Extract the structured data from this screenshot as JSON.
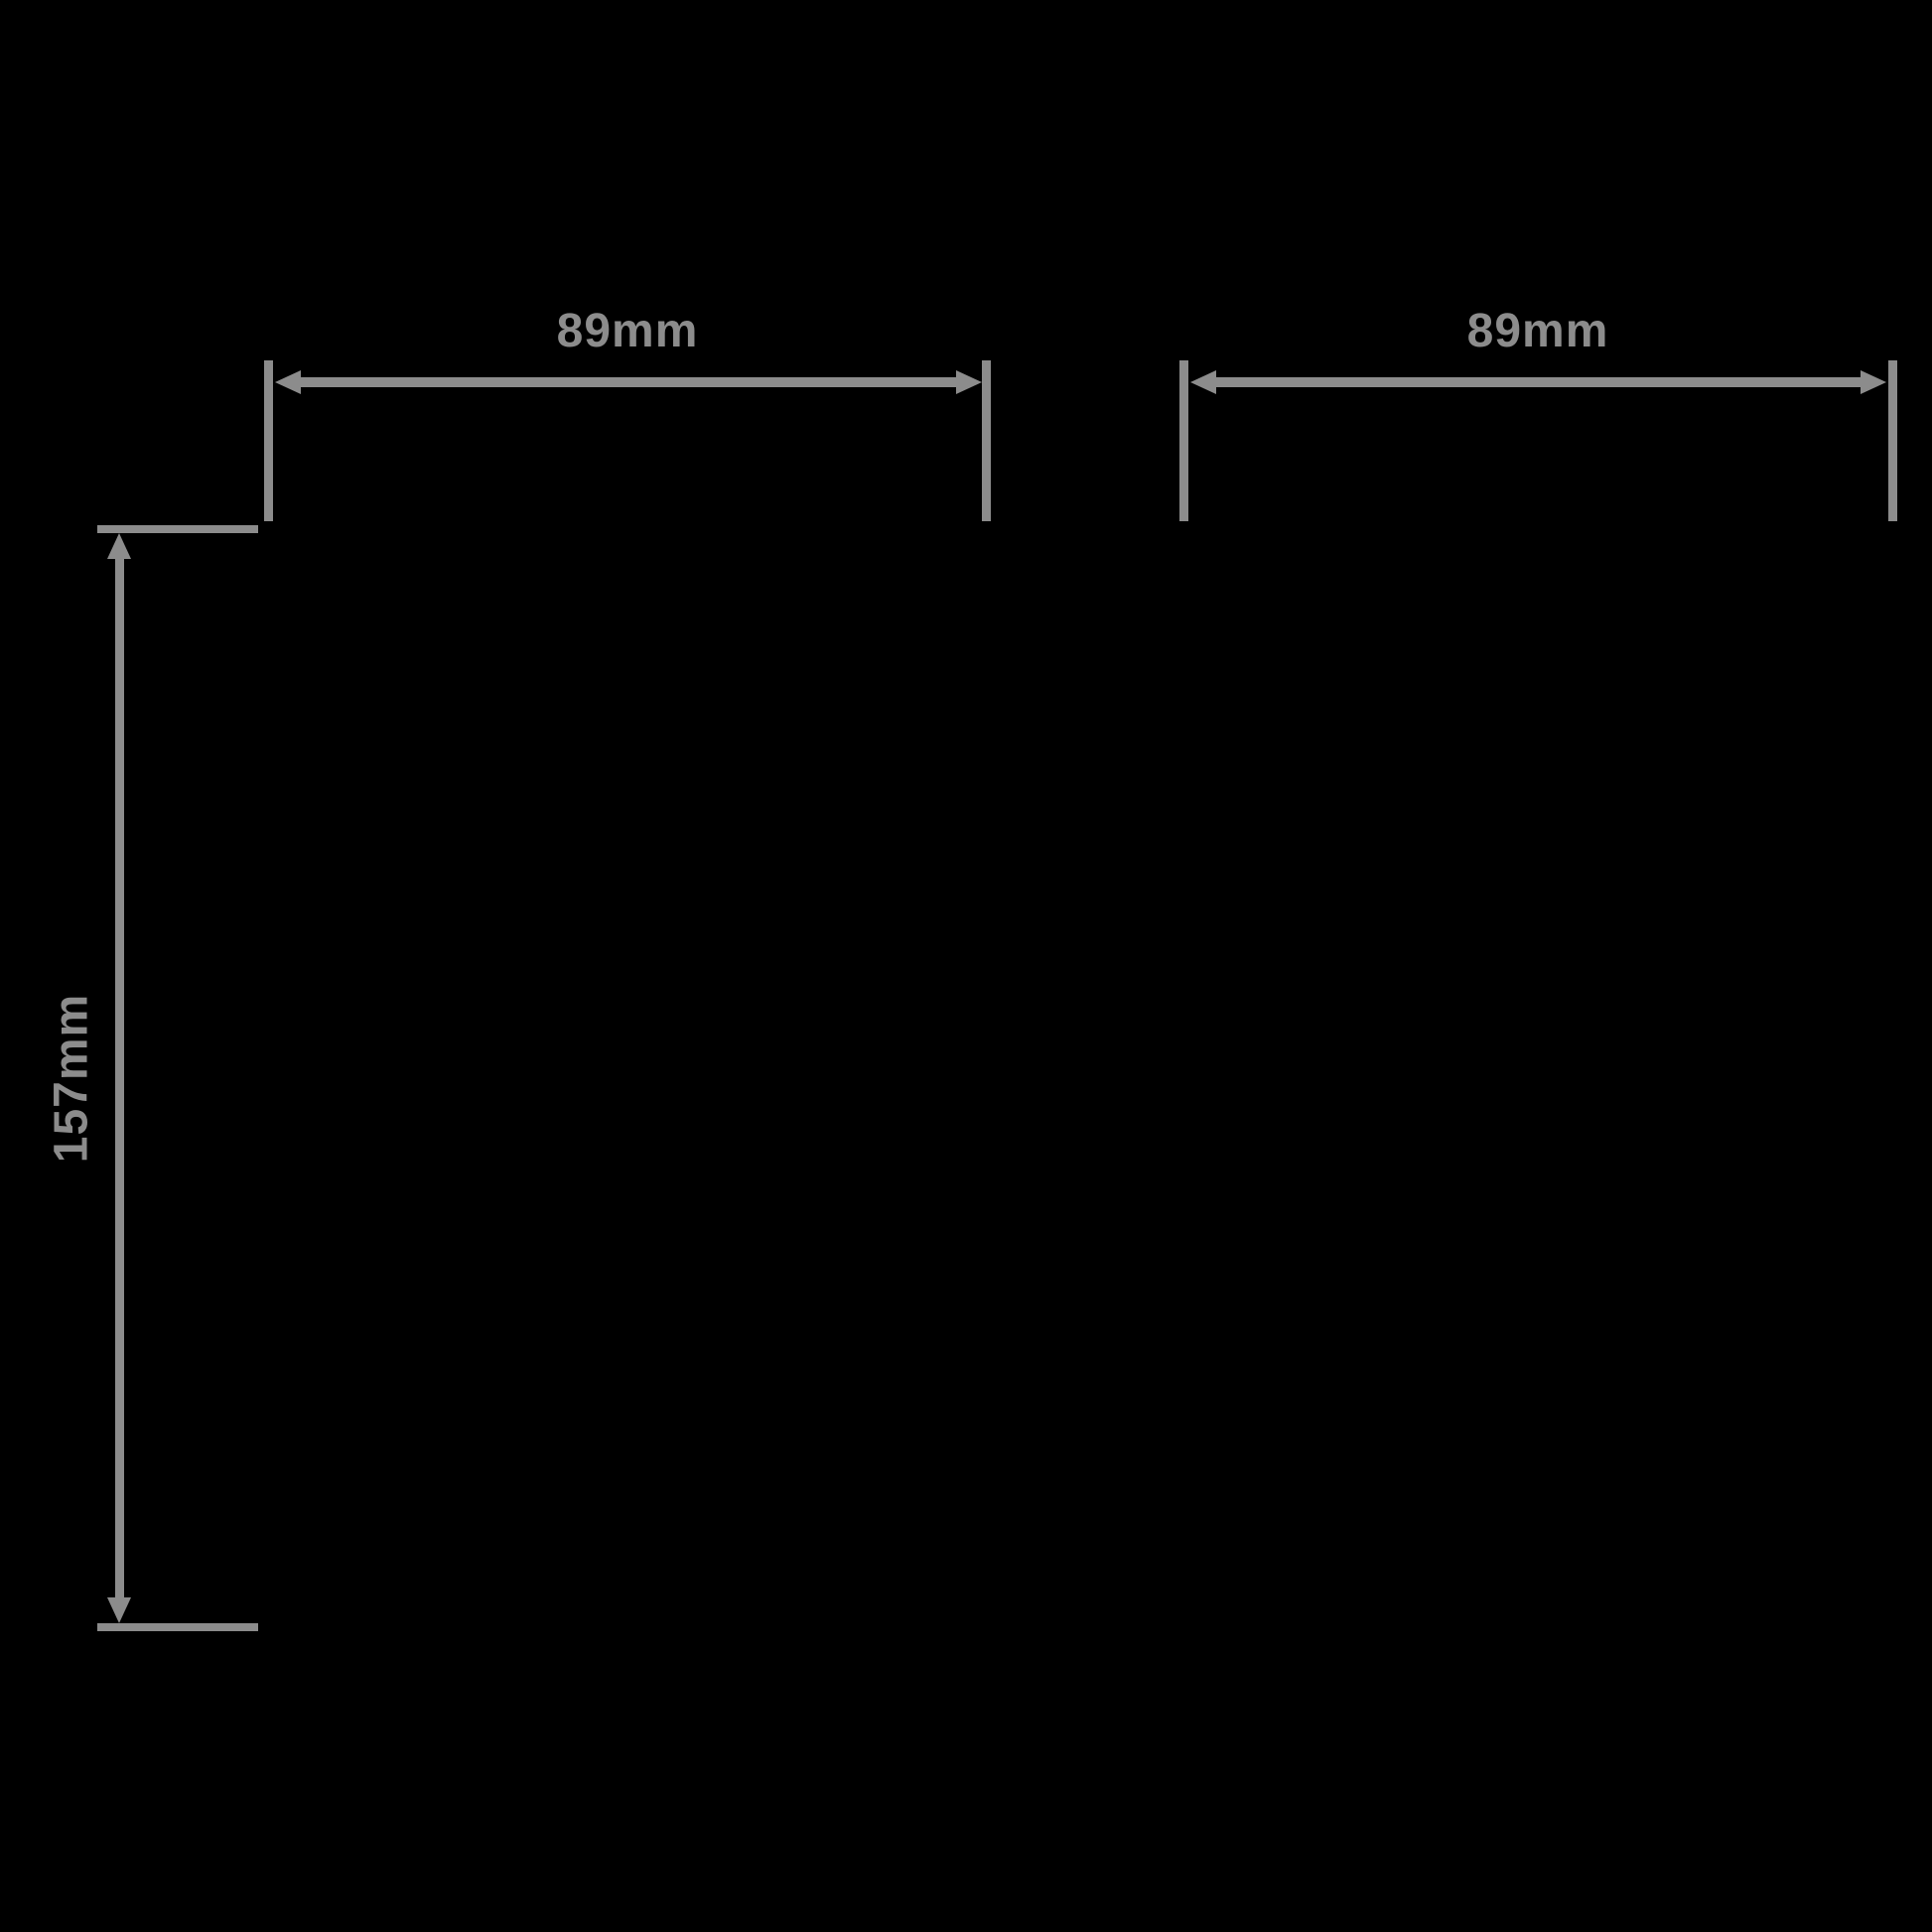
{
  "canvas": {
    "background_color": "#000000",
    "line_color": "#8C8C8C"
  },
  "dimensions": {
    "top_left_width": {
      "label": "89mm",
      "value_mm": 89,
      "orientation": "horizontal"
    },
    "top_right_width": {
      "label": "89mm",
      "value_mm": 89,
      "orientation": "horizontal"
    },
    "left_height": {
      "label": "157mm",
      "value_mm": 157,
      "orientation": "vertical"
    }
  }
}
